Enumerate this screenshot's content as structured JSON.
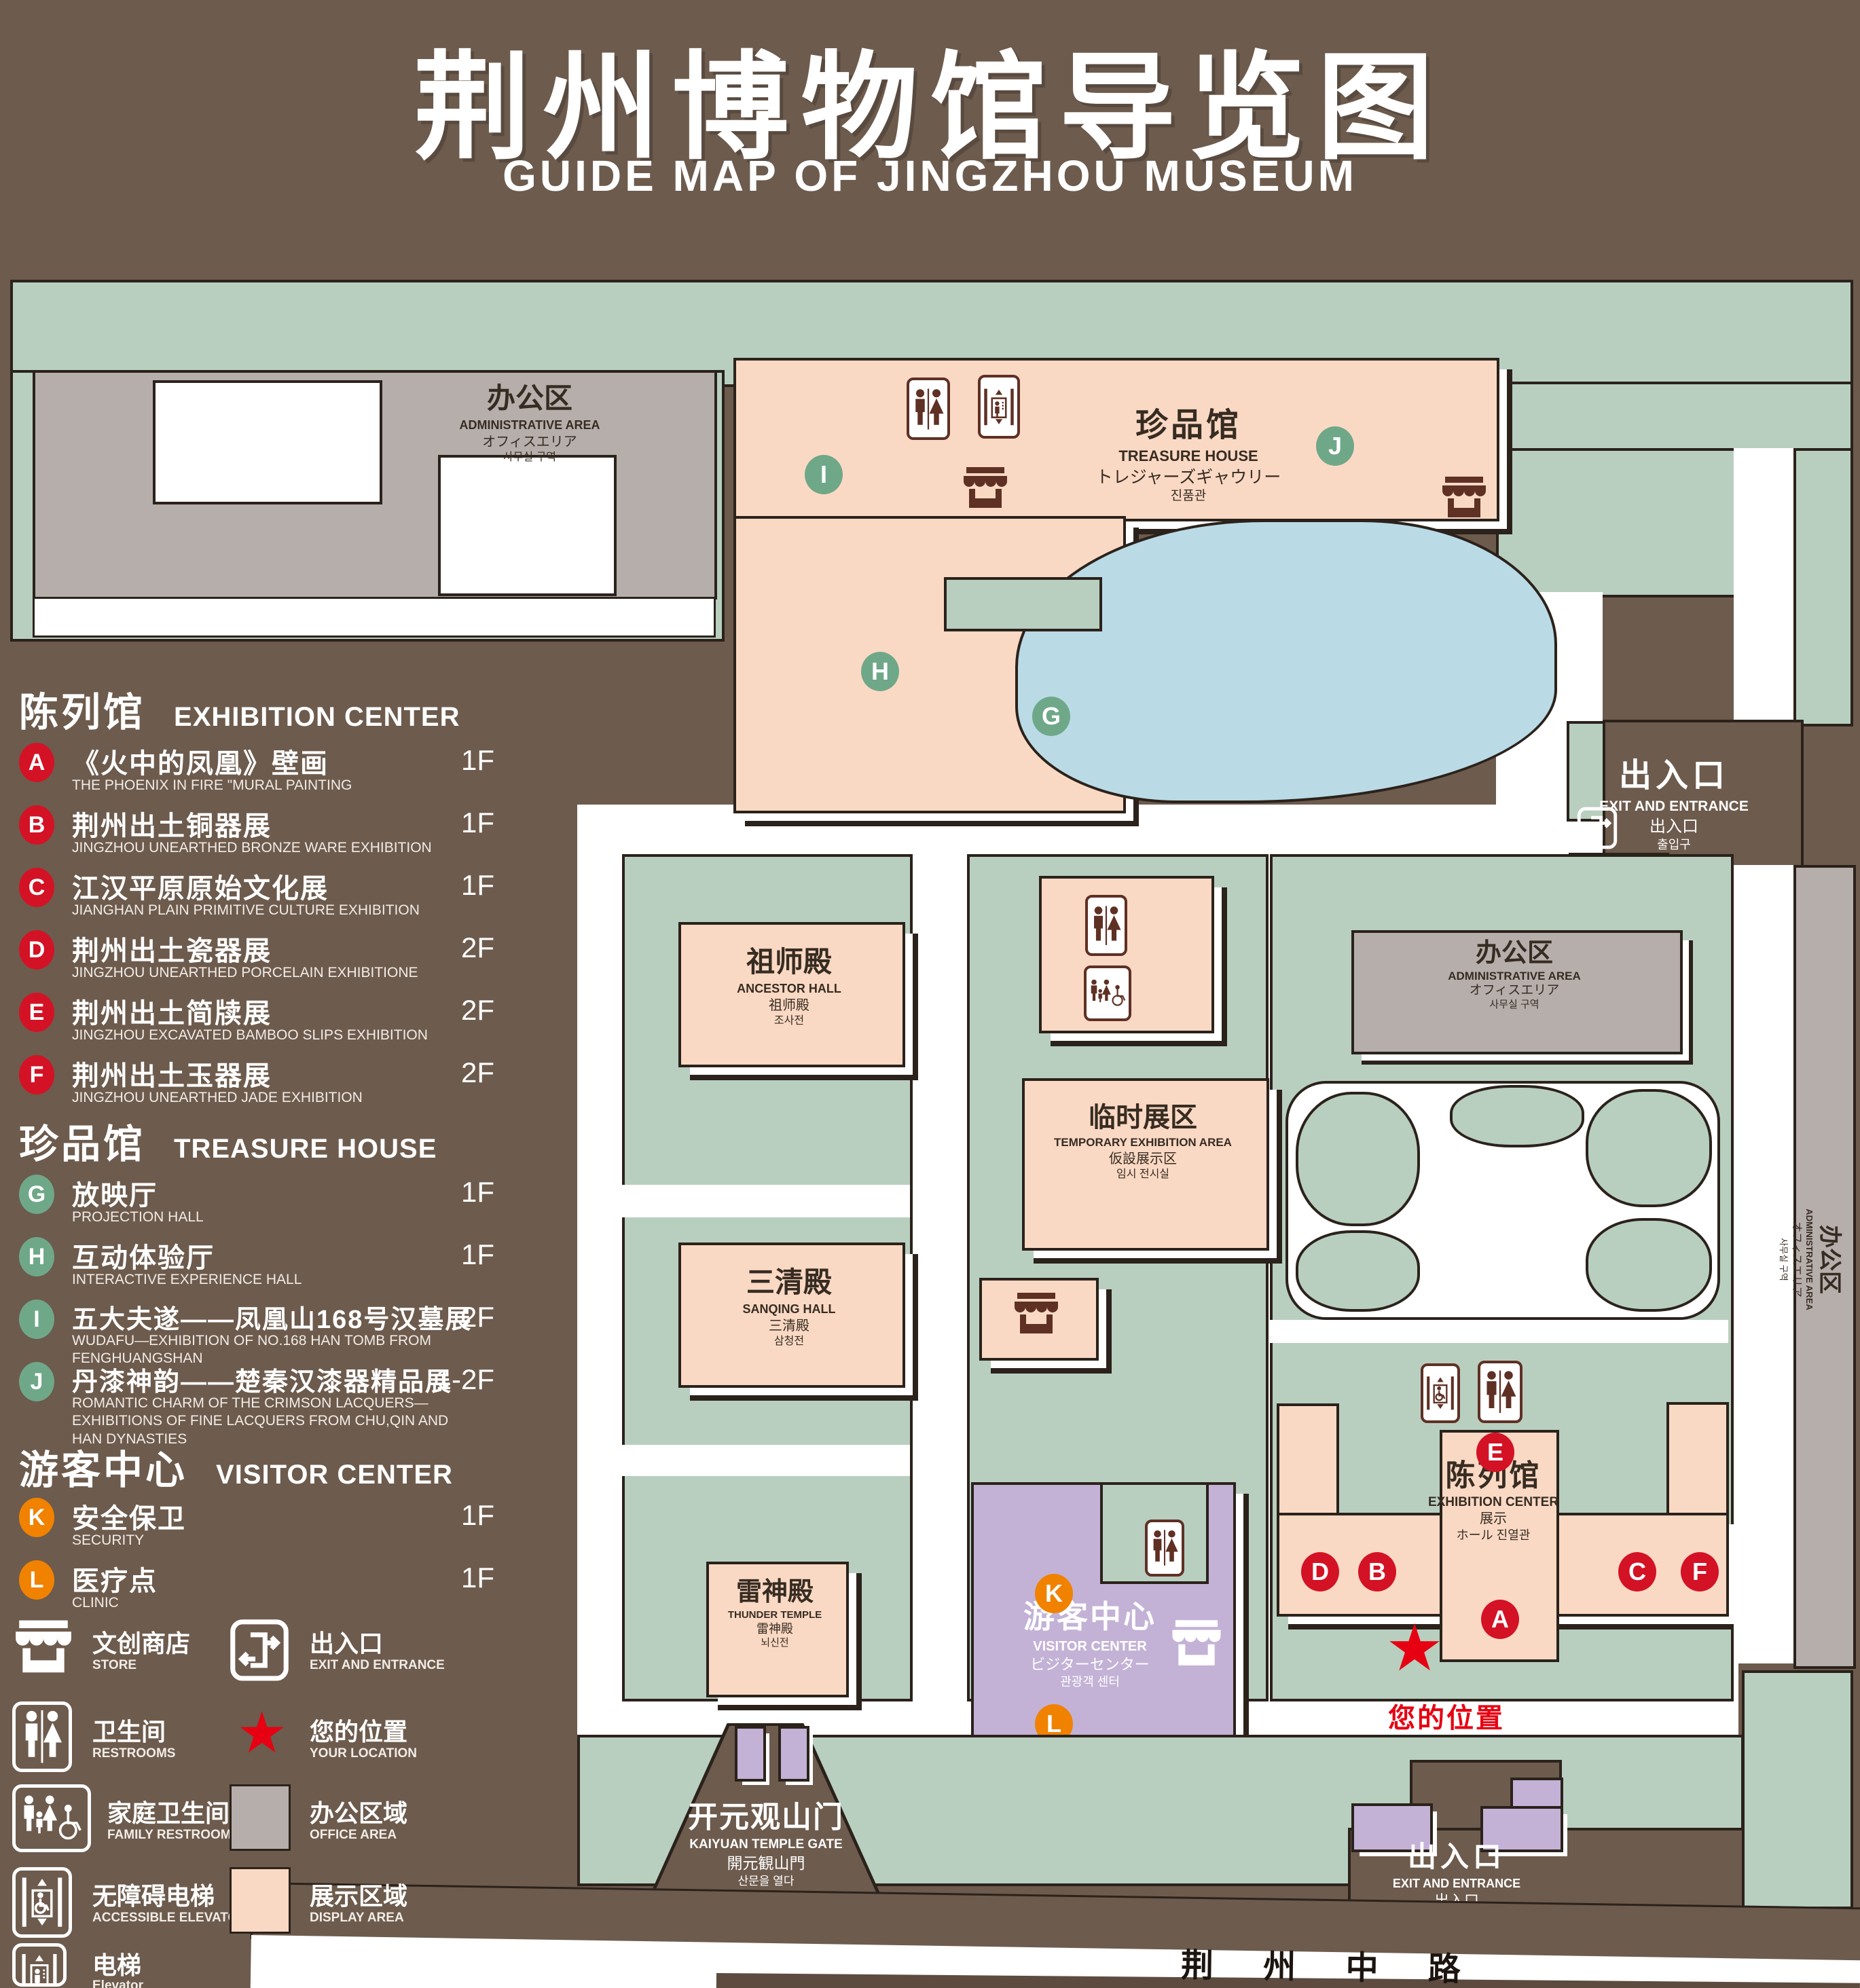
{
  "title": {
    "zh": "荆州博物馆导览图",
    "en": "GUIDE MAP OF JINGZHOU MUSEUM"
  },
  "legend": {
    "sections": [
      {
        "zh": "陈列馆",
        "en": "EXHIBITION CENTER",
        "items": [
          {
            "letter": "A",
            "zh": "《火中的凤凰》壁画",
            "en": "THE PHOENIX IN FIRE \"MURAL PAINTING",
            "floor": "1F"
          },
          {
            "letter": "B",
            "zh": "荆州出土铜器展",
            "en": "JINGZHOU UNEARTHED BRONZE WARE EXHIBITION",
            "floor": "1F"
          },
          {
            "letter": "C",
            "zh": "江汉平原原始文化展",
            "en": "JIANGHAN PLAIN PRIMITIVE CULTURE EXHIBITION",
            "floor": "1F"
          },
          {
            "letter": "D",
            "zh": "荆州出土瓷器展",
            "en": "JINGZHOU UNEARTHED PORCELAIN EXHIBITIONE",
            "floor": "2F"
          },
          {
            "letter": "E",
            "zh": "荆州出土简牍展",
            "en": "JINGZHOU EXCAVATED BAMBOO SLIPS EXHIBITION",
            "floor": "2F"
          },
          {
            "letter": "F",
            "zh": "荆州出土玉器展",
            "en": "JINGZHOU UNEARTHED JADE EXHIBITION",
            "floor": "2F"
          }
        ]
      },
      {
        "zh": "珍品馆",
        "en": "TREASURE HOUSE",
        "items": [
          {
            "letter": "G",
            "zh": "放映厅",
            "en": "PROJECTION HALL",
            "floor": "1F"
          },
          {
            "letter": "H",
            "zh": "互动体验厅",
            "en": "INTERACTIVE EXPERIENCE HALL",
            "floor": "1F"
          },
          {
            "letter": "I",
            "zh": "五大夫遂——凤凰山168号汉墓展",
            "en": "WUDAFU—EXHIBITION OF NO.168 HAN TOMB FROM FENGHUANGSHAN",
            "floor": "2F"
          },
          {
            "letter": "J",
            "zh": "丹漆神韵——楚秦汉漆器精品展",
            "en": "ROMANTIC CHARM OF THE CRIMSON LACQUERS—EXHIBITIONS OF FINE LACQUERS FROM CHU,QIN AND HAN DYNASTIES",
            "floor": "1-2F"
          }
        ]
      },
      {
        "zh": "游客中心",
        "en": "VISITOR CENTER",
        "items": [
          {
            "letter": "K",
            "zh": "安全保卫",
            "en": "SECURITY",
            "floor": "1F"
          },
          {
            "letter": "L",
            "zh": "医疗点",
            "en": "CLINIC",
            "floor": "1F"
          }
        ]
      }
    ],
    "symbols": [
      {
        "icon": "store-icon",
        "zh": "文创商店",
        "en": "STORE"
      },
      {
        "icon": "exit-icon",
        "zh": "出入口",
        "en": "EXIT AND ENTRANCE"
      },
      {
        "icon": "restrooms-icon",
        "zh": "卫生间",
        "en": "RESTROOMS"
      },
      {
        "icon": "location-star-icon",
        "zh": "您的位置",
        "en": "YOUR LOCATION"
      },
      {
        "icon": "family-restrooms-icon",
        "zh": "家庭卫生间",
        "en": "FAMILY RESTROOMS"
      },
      {
        "icon": "office-area-swatch",
        "zh": "办公区域",
        "en": "OFFICE AREA"
      },
      {
        "icon": "accessible-elevator-icon",
        "zh": "无障碍电梯",
        "en": "ACCESSIBLE ELEVATOR"
      },
      {
        "icon": "display-area-swatch",
        "zh": "展示区域",
        "en": "DISPLAY AREA"
      },
      {
        "icon": "elevator-icon",
        "zh": "电梯",
        "en": "Elevator"
      }
    ]
  },
  "map": {
    "admin_nw": {
      "zh": "办公区",
      "en": "ADMINISTRATIVE AREA",
      "ja": "オフィスエリア",
      "ko": "사무실 구역"
    },
    "treasure_house": {
      "zh": "珍品馆",
      "en": "TREASURE HOUSE",
      "ja": "トレジャーズギャウリー",
      "ko": "진품관"
    },
    "exit_ne": {
      "zh": "出入口",
      "en": "EXIT AND ENTRANCE",
      "ja": "出入口",
      "ko": "출입구"
    },
    "ancestor_hall": {
      "zh": "祖师殿",
      "en": "ANCESTOR HALL",
      "ja": "祖师殿",
      "ko": "조사전"
    },
    "admin_mid": {
      "zh": "办公区",
      "en": "ADMINISTRATIVE AREA",
      "ja": "オフィスエリア",
      "ko": "사무실 구역"
    },
    "temp_exhibition": {
      "zh": "临时展区",
      "en": "TEMPORARY EXHIBITION AREA",
      "ja": "仮設展示区",
      "ko": "임시 전시실"
    },
    "sanqing_hall": {
      "zh": "三清殿",
      "en": "SANQING HALL",
      "ja": "三清殿",
      "ko": "삼청전"
    },
    "admin_east": {
      "zh": "办公区",
      "en": "ADMINISTRATIVE AREA",
      "ja": "オフィスエリア",
      "ko": "사무실 구역"
    },
    "exhibition_center": {
      "zh": "陈列馆",
      "en": "EXHIBITION CENTER",
      "sub1": "展示",
      "sub2": "ホール 진열관"
    },
    "thunder_temple": {
      "zh": "雷神殿",
      "en": "THUNDER TEMPLE",
      "ja": "雷神殿",
      "ko": "뇌신전"
    },
    "visitor_center": {
      "zh": "游客中心",
      "en": "VISITOR CENTER",
      "ja": "ビジターセンター",
      "ko": "관광객 센터"
    },
    "your_location": {
      "zh": "您的位置"
    },
    "gate": {
      "zh": "开元观山门",
      "en": "KAIYUAN TEMPLE GATE",
      "ja": "開元観山門",
      "ko": "산문을 열다"
    },
    "exit_se": {
      "zh": "出入口",
      "en": "EXIT AND ENTRANCE",
      "ja": "出入口",
      "ko": "출입구"
    },
    "road": {
      "zh": "荆 州 中 路"
    },
    "badges": {
      "a": "A",
      "b": "B",
      "c": "C",
      "d": "D",
      "e": "E",
      "f": "F",
      "g": "G",
      "h": "H",
      "i": "I",
      "j": "J",
      "k": "K",
      "l": "L"
    }
  },
  "colors": {
    "background": "#6d5b4d",
    "courtyard_green": "#b8cfc0",
    "display_pink": "#fad9c4",
    "office_gray": "#b5aeab",
    "lake_blue": "#badae6",
    "entrance_purple": "#c3b2d6",
    "outline": "#2b221b",
    "icon_maroon": "#5f3024",
    "badge_red": "#d41225",
    "badge_green": "#6fa888",
    "badge_orange": "#f08200",
    "star_red": "#e60012"
  }
}
